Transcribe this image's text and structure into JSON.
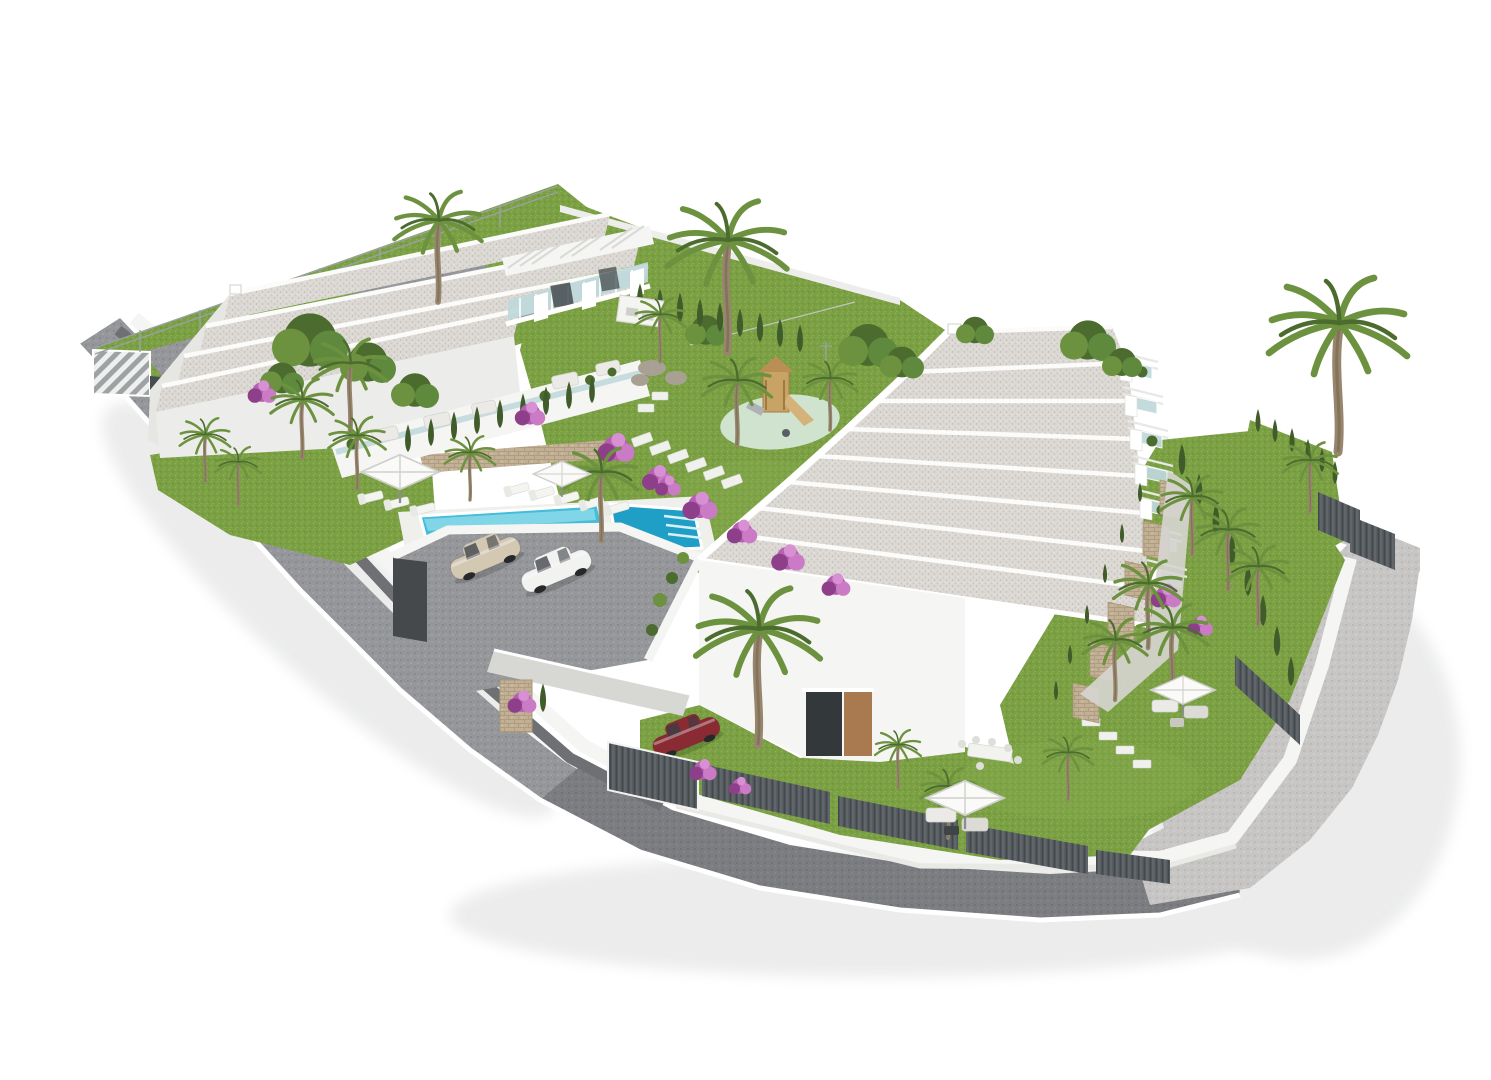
{
  "title": "Aerial 3D render - white terraced residential complex with gardens, pools and parking",
  "colors": {
    "bg": "#ffffff",
    "wallWhite": "#f5f5f3",
    "wallShade": "#e6e6e3",
    "wallDark": "#6e7073",
    "roofGravel": "#dcd9d4",
    "parapet": "#fbfbfa",
    "glass": "#bfd8dc",
    "roadAsphalt": "#96979a",
    "roadDark": "#7c7d80",
    "pavement": "#c7c6c4",
    "curb": "#ffffff",
    "slat": "#585e62",
    "stone": "#c1b096",
    "grass": "#7ba043",
    "grassLight": "#8db155",
    "grassDark": "#5f7f33",
    "cypress": "#415c2b",
    "palmLeaf": "#6d923f",
    "palmLeafDark": "#4c6c2f",
    "trunk": "#97866c",
    "flower": "#b75fb2",
    "flowerDeep": "#8e3f8a",
    "mint": "#cfe3cf",
    "wood": "#c9a265",
    "poolWater": "#45bcd9",
    "poolLight": "#8edbea",
    "poolDark": "#1f9ec6",
    "umbrella": "#fafaf8",
    "umbrellaSeam": "#cfcfcb",
    "carChampagne": "#d3c8b2",
    "carWhite": "#f2f2f1",
    "carGrey": "#646a70",
    "carRed": "#8a2a33",
    "furniture": "#eceae6",
    "shadow": "#dcdddd"
  },
  "scene": {
    "left_building": {
      "label": "Block A terraced houses",
      "roof_strips": 4,
      "floors": 2
    },
    "right_building": {
      "label": "Block B terraced houses",
      "roof_strips": 8,
      "balcony_bays": 7,
      "stone_terrace_walls": 6
    },
    "pool": {
      "label": "Community pool",
      "sections": 2,
      "sun_loungers": 8,
      "shade_umbrellas": 2
    },
    "parking": {
      "label": "Parking terraces",
      "gates": 3
    },
    "vehicles": [
      {
        "id": "car-grey",
        "color": "grey"
      },
      {
        "id": "car-champagne",
        "color": "champagne"
      },
      {
        "id": "car-white",
        "color": "white"
      },
      {
        "id": "car-red",
        "color": "dark red"
      }
    ],
    "playground": {
      "label": "Children playground",
      "surface": "mint green",
      "equipment": [
        "wooden tower",
        "slide",
        "spring rider"
      ]
    },
    "gardens": {
      "palm_trees": 24,
      "cypress_hedges": 4,
      "bougainvillea_patches": 12,
      "stepping_stone_paths": 3
    },
    "umbrellas_total": 4
  }
}
